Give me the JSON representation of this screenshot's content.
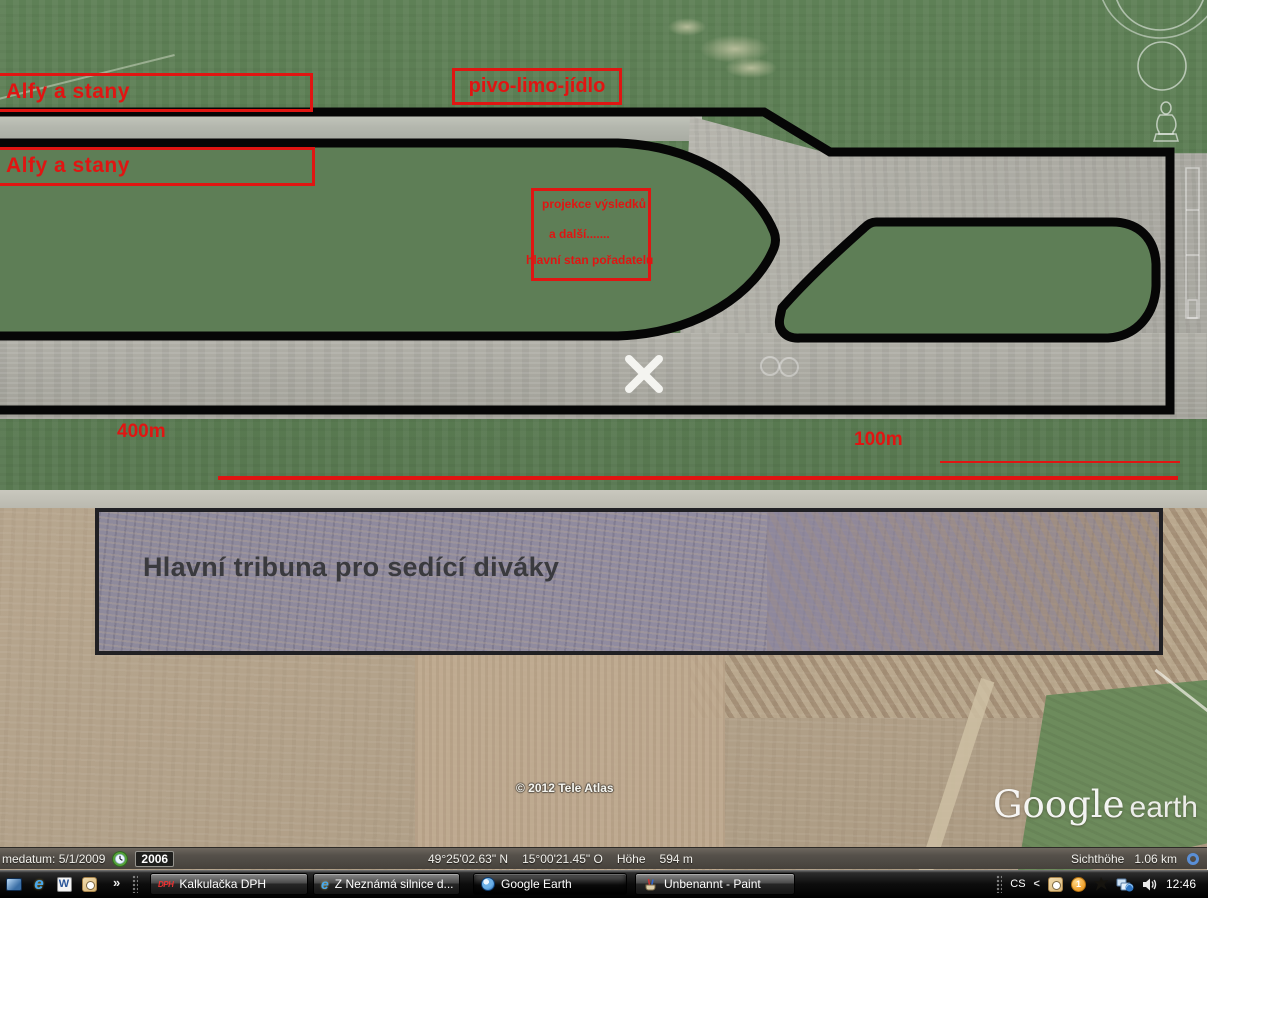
{
  "map": {
    "annotations": {
      "annotation_color": "#e01512",
      "box_alfy_top": "Alfy a stany",
      "box_alfy_bottom": "Alfy a stany",
      "box_pivo": "pivo-limo-jídlo",
      "box_projekce_line1": "projekce výsledků",
      "box_projekce_line2": "a další.......",
      "box_projekce_line3": "hlavní stan pořadatelů",
      "label_400m": "400m",
      "label_100m": "100m",
      "tribuna_label": "Hlavní tribuna pro sedící diváky"
    },
    "watermark": {
      "copyright": "© 2012 Tele Atlas",
      "logo_google": "Google",
      "logo_earth": "earth"
    },
    "statusbar": {
      "imagery_date": "medatum: 5/1/2009",
      "year_badge": "2006",
      "latitude": "49°25'02.63\" N",
      "longitude": "15°00'21.45\" O",
      "elevation_label": "Höhe",
      "elevation_value": "594 m",
      "eye_alt_label": "Sichthöhe",
      "eye_alt_value": "1.06 km"
    }
  },
  "taskbar": {
    "overflow_chevron": "»",
    "quick_launch_icons": [
      "show-desktop-icon",
      "internet-explorer-icon",
      "word-icon",
      "outlook-icon"
    ],
    "buttons": [
      {
        "label": "Kalkulačka DPH",
        "icon": "dph-calculator-icon",
        "icon_glyph": "DPH",
        "active": false
      },
      {
        "label": "Z Neznámá silnice d...",
        "icon": "internet-explorer-icon",
        "icon_glyph": "e",
        "active": false
      },
      {
        "label": "Google Earth",
        "icon": "google-earth-globe-icon",
        "icon_glyph": "",
        "active": true
      },
      {
        "label": "Unbenannt - Paint",
        "icon": "paint-icon",
        "icon_glyph": "",
        "active": false
      }
    ],
    "tray": {
      "language": "CS",
      "collapse_chevron": "<",
      "update_badge": "1",
      "clock": "12:46"
    },
    "icons": {
      "word_glyph": "W",
      "ie_glyph": "e"
    },
    "colors": {
      "taskbar_bg": "#0d0d0d",
      "status_bar_bg": "#4e4a44",
      "field_green": "#5c7c54",
      "pavement_gray": "#adaba2",
      "field_tan": "#b3a28a",
      "outline_black": "#050505",
      "stream_ring_blue": "#5a8fd6"
    }
  }
}
